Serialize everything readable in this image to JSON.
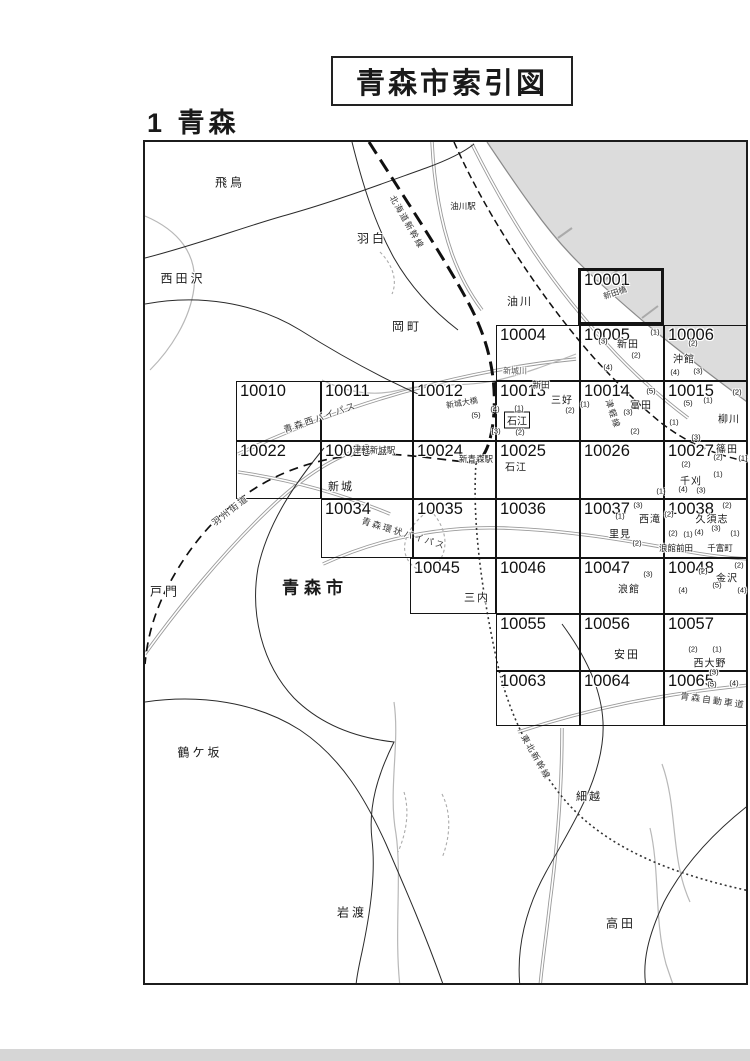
{
  "page": {
    "title": "青森市索引図",
    "section": "1 青森"
  },
  "map": {
    "frame": {
      "x": 143,
      "y": 140,
      "w": 605,
      "h": 845
    },
    "sea_color": "#dcdcdc",
    "cells": [
      {
        "id": "10001",
        "x": 578,
        "y": 268,
        "w": 86,
        "h": 57,
        "thick": true
      },
      {
        "id": "10004",
        "x": 496,
        "y": 325,
        "w": 84,
        "h": 56
      },
      {
        "id": "10005",
        "x": 580,
        "y": 325,
        "w": 84,
        "h": 56
      },
      {
        "id": "10006",
        "x": 664,
        "y": 325,
        "w": 83,
        "h": 56
      },
      {
        "id": "10010",
        "x": 236,
        "y": 381,
        "w": 85,
        "h": 60
      },
      {
        "id": "10011",
        "x": 321,
        "y": 381,
        "w": 92,
        "h": 60
      },
      {
        "id": "10012",
        "x": 413,
        "y": 381,
        "w": 83,
        "h": 60
      },
      {
        "id": "10013",
        "x": 496,
        "y": 381,
        "w": 84,
        "h": 60
      },
      {
        "id": "10014",
        "x": 580,
        "y": 381,
        "w": 84,
        "h": 60
      },
      {
        "id": "10015",
        "x": 664,
        "y": 381,
        "w": 83,
        "h": 60
      },
      {
        "id": "10022",
        "x": 236,
        "y": 441,
        "w": 85,
        "h": 58
      },
      {
        "id": "10023",
        "x": 321,
        "y": 441,
        "w": 92,
        "h": 58
      },
      {
        "id": "10024",
        "x": 413,
        "y": 441,
        "w": 83,
        "h": 58
      },
      {
        "id": "10025",
        "x": 496,
        "y": 441,
        "w": 84,
        "h": 58
      },
      {
        "id": "10026",
        "x": 580,
        "y": 441,
        "w": 84,
        "h": 58
      },
      {
        "id": "10027",
        "x": 664,
        "y": 441,
        "w": 83,
        "h": 58
      },
      {
        "id": "10034",
        "x": 321,
        "y": 499,
        "w": 92,
        "h": 59
      },
      {
        "id": "10035",
        "x": 413,
        "y": 499,
        "w": 83,
        "h": 59
      },
      {
        "id": "10036",
        "x": 496,
        "y": 499,
        "w": 84,
        "h": 59
      },
      {
        "id": "10037",
        "x": 580,
        "y": 499,
        "w": 84,
        "h": 59
      },
      {
        "id": "10038",
        "x": 664,
        "y": 499,
        "w": 83,
        "h": 59
      },
      {
        "id": "10045",
        "x": 410,
        "y": 558,
        "w": 86,
        "h": 56
      },
      {
        "id": "10046",
        "x": 496,
        "y": 558,
        "w": 84,
        "h": 56
      },
      {
        "id": "10047",
        "x": 580,
        "y": 558,
        "w": 84,
        "h": 56
      },
      {
        "id": "10048",
        "x": 664,
        "y": 558,
        "w": 83,
        "h": 56
      },
      {
        "id": "10055",
        "x": 496,
        "y": 614,
        "w": 84,
        "h": 57
      },
      {
        "id": "10056",
        "x": 580,
        "y": 614,
        "w": 84,
        "h": 57
      },
      {
        "id": "10057",
        "x": 664,
        "y": 614,
        "w": 83,
        "h": 57
      },
      {
        "id": "10063",
        "x": 496,
        "y": 671,
        "w": 84,
        "h": 55
      },
      {
        "id": "10064",
        "x": 580,
        "y": 671,
        "w": 84,
        "h": 55
      },
      {
        "id": "10065",
        "x": 664,
        "y": 671,
        "w": 83,
        "h": 55
      }
    ],
    "labels": [
      {
        "t": "飛鳥",
        "x": 230,
        "y": 182,
        "k": "region"
      },
      {
        "t": "西田沢",
        "x": 183,
        "y": 278,
        "k": "region"
      },
      {
        "t": "羽白",
        "x": 372,
        "y": 238,
        "k": "region"
      },
      {
        "t": "岡町",
        "x": 407,
        "y": 326,
        "k": "region"
      },
      {
        "t": "戸門",
        "x": 165,
        "y": 591,
        "k": "region"
      },
      {
        "t": "鶴ケ坂",
        "x": 200,
        "y": 752,
        "k": "region"
      },
      {
        "t": "岩渡",
        "x": 352,
        "y": 912,
        "k": "region"
      },
      {
        "t": "高田",
        "x": 621,
        "y": 923,
        "k": "region"
      },
      {
        "t": "油川",
        "x": 520,
        "y": 301,
        "k": "region2"
      },
      {
        "t": "新城",
        "x": 341,
        "y": 486,
        "k": "region2"
      },
      {
        "t": "三内",
        "x": 477,
        "y": 597,
        "k": "region2"
      },
      {
        "t": "安田",
        "x": 627,
        "y": 654,
        "k": "region2"
      },
      {
        "t": "細越",
        "x": 589,
        "y": 796,
        "k": "region2"
      },
      {
        "t": "青森市",
        "x": 315,
        "y": 586,
        "k": "city"
      },
      {
        "t": "新田",
        "x": 628,
        "y": 343,
        "k": "district"
      },
      {
        "t": "新田",
        "x": 541,
        "y": 385,
        "k": "districtsm"
      },
      {
        "t": "三好",
        "x": 562,
        "y": 399,
        "k": "district"
      },
      {
        "t": "富田",
        "x": 641,
        "y": 404,
        "k": "district"
      },
      {
        "t": "沖館",
        "x": 684,
        "y": 358,
        "k": "district"
      },
      {
        "t": "柳川",
        "x": 729,
        "y": 418,
        "k": "district"
      },
      {
        "t": "石江",
        "x": 517,
        "y": 420,
        "k": "boxed"
      },
      {
        "t": "石江",
        "x": 516,
        "y": 466,
        "k": "district"
      },
      {
        "t": "篠田",
        "x": 727,
        "y": 448,
        "k": "district"
      },
      {
        "t": "千刈",
        "x": 691,
        "y": 480,
        "k": "district"
      },
      {
        "t": "西滝",
        "x": 650,
        "y": 518,
        "k": "district"
      },
      {
        "t": "里見",
        "x": 620,
        "y": 533,
        "k": "district"
      },
      {
        "t": "久須志",
        "x": 712,
        "y": 518,
        "k": "district"
      },
      {
        "t": "浪館前田",
        "x": 676,
        "y": 548,
        "k": "districtsm"
      },
      {
        "t": "千富町",
        "x": 720,
        "y": 548,
        "k": "districtsm"
      },
      {
        "t": "浪館",
        "x": 629,
        "y": 588,
        "k": "district"
      },
      {
        "t": "金沢",
        "x": 727,
        "y": 577,
        "k": "district"
      },
      {
        "t": "西大野",
        "x": 710,
        "y": 662,
        "k": "district"
      },
      {
        "t": "油川駅",
        "x": 463,
        "y": 206,
        "k": "station"
      },
      {
        "t": "津軽新城駅",
        "x": 374,
        "y": 450,
        "k": "station"
      },
      {
        "t": "新青森駅",
        "x": 476,
        "y": 459,
        "k": "station"
      },
      {
        "t": "北海道新幹線",
        "x": 407,
        "y": 222,
        "k": "rail",
        "r": 60
      },
      {
        "t": "津軽線",
        "x": 613,
        "y": 414,
        "k": "rail",
        "r": 72
      },
      {
        "t": "東北新幹線",
        "x": 536,
        "y": 757,
        "k": "rail",
        "r": 60
      },
      {
        "t": "青森西バイパス",
        "x": 320,
        "y": 417,
        "k": "road",
        "r": -19
      },
      {
        "t": "羽州街道",
        "x": 230,
        "y": 510,
        "k": "road",
        "r": -38
      },
      {
        "t": "青森環状バイパス",
        "x": 404,
        "y": 533,
        "k": "road",
        "r": 17
      },
      {
        "t": "青森自動車道",
        "x": 713,
        "y": 700,
        "k": "road",
        "r": 8
      },
      {
        "t": "新城川",
        "x": 515,
        "y": 371,
        "k": "river"
      },
      {
        "t": "新田橋",
        "x": 615,
        "y": 293,
        "k": "bridge",
        "r": -19
      },
      {
        "t": "新城大橋",
        "x": 462,
        "y": 403,
        "k": "bridge",
        "r": -10
      },
      {
        "t": "(3)",
        "x": 603,
        "y": 341,
        "k": "num"
      },
      {
        "t": "(1)",
        "x": 655,
        "y": 332,
        "k": "num"
      },
      {
        "t": "(2)",
        "x": 636,
        "y": 355,
        "k": "num"
      },
      {
        "t": "(4)",
        "x": 608,
        "y": 367,
        "k": "num"
      },
      {
        "t": "(2)",
        "x": 693,
        "y": 343,
        "k": "num"
      },
      {
        "t": "(3)",
        "x": 698,
        "y": 371,
        "k": "num"
      },
      {
        "t": "(4)",
        "x": 675,
        "y": 372,
        "k": "num"
      },
      {
        "t": "(5)",
        "x": 476,
        "y": 415,
        "k": "num"
      },
      {
        "t": "(4)",
        "x": 495,
        "y": 409,
        "k": "num"
      },
      {
        "t": "(1)",
        "x": 519,
        "y": 408,
        "k": "num"
      },
      {
        "t": "(3)",
        "x": 496,
        "y": 431,
        "k": "num"
      },
      {
        "t": "(2)",
        "x": 520,
        "y": 432,
        "k": "num"
      },
      {
        "t": "(2)",
        "x": 570,
        "y": 410,
        "k": "num"
      },
      {
        "t": "(1)",
        "x": 585,
        "y": 404,
        "k": "num"
      },
      {
        "t": "(5)",
        "x": 651,
        "y": 391,
        "k": "num"
      },
      {
        "t": "(3)",
        "x": 628,
        "y": 412,
        "k": "num"
      },
      {
        "t": "(2)",
        "x": 635,
        "y": 431,
        "k": "num"
      },
      {
        "t": "(5)",
        "x": 688,
        "y": 403,
        "k": "num"
      },
      {
        "t": "(1)",
        "x": 708,
        "y": 400,
        "k": "num"
      },
      {
        "t": "(2)",
        "x": 737,
        "y": 392,
        "k": "num"
      },
      {
        "t": "(1)",
        "x": 674,
        "y": 422,
        "k": "num"
      },
      {
        "t": "(3)",
        "x": 696,
        "y": 437,
        "k": "num"
      },
      {
        "t": "(2)",
        "x": 718,
        "y": 457,
        "k": "num"
      },
      {
        "t": "(1)",
        "x": 743,
        "y": 458,
        "k": "num"
      },
      {
        "t": "(2)",
        "x": 686,
        "y": 464,
        "k": "num"
      },
      {
        "t": "(1)",
        "x": 718,
        "y": 474,
        "k": "num"
      },
      {
        "t": "(4)",
        "x": 683,
        "y": 489,
        "k": "num"
      },
      {
        "t": "(3)",
        "x": 701,
        "y": 490,
        "k": "num"
      },
      {
        "t": "(1)",
        "x": 661,
        "y": 491,
        "k": "num"
      },
      {
        "t": "(3)",
        "x": 638,
        "y": 505,
        "k": "num"
      },
      {
        "t": "(1)",
        "x": 620,
        "y": 516,
        "k": "num"
      },
      {
        "t": "(2)",
        "x": 669,
        "y": 514,
        "k": "num"
      },
      {
        "t": "(2)",
        "x": 637,
        "y": 543,
        "k": "num"
      },
      {
        "t": "(2)",
        "x": 727,
        "y": 505,
        "k": "num"
      },
      {
        "t": "(3)",
        "x": 716,
        "y": 528,
        "k": "num"
      },
      {
        "t": "(4)",
        "x": 699,
        "y": 532,
        "k": "num"
      },
      {
        "t": "(1)",
        "x": 735,
        "y": 533,
        "k": "num"
      },
      {
        "t": "(2)",
        "x": 673,
        "y": 533,
        "k": "num"
      },
      {
        "t": "(1)",
        "x": 688,
        "y": 534,
        "k": "num"
      },
      {
        "t": "(3)",
        "x": 648,
        "y": 574,
        "k": "num"
      },
      {
        "t": "(2)",
        "x": 739,
        "y": 565,
        "k": "num"
      },
      {
        "t": "(2)",
        "x": 703,
        "y": 571,
        "k": "num"
      },
      {
        "t": "(5)",
        "x": 717,
        "y": 585,
        "k": "num"
      },
      {
        "t": "(4)",
        "x": 683,
        "y": 590,
        "k": "num"
      },
      {
        "t": "(4)",
        "x": 742,
        "y": 590,
        "k": "num"
      },
      {
        "t": "(2)",
        "x": 693,
        "y": 649,
        "k": "num"
      },
      {
        "t": "(1)",
        "x": 717,
        "y": 649,
        "k": "num"
      },
      {
        "t": "(3)",
        "x": 714,
        "y": 672,
        "k": "num"
      },
      {
        "t": "(5)",
        "x": 712,
        "y": 684,
        "k": "num"
      },
      {
        "t": "(4)",
        "x": 734,
        "y": 683,
        "k": "num"
      }
    ]
  }
}
